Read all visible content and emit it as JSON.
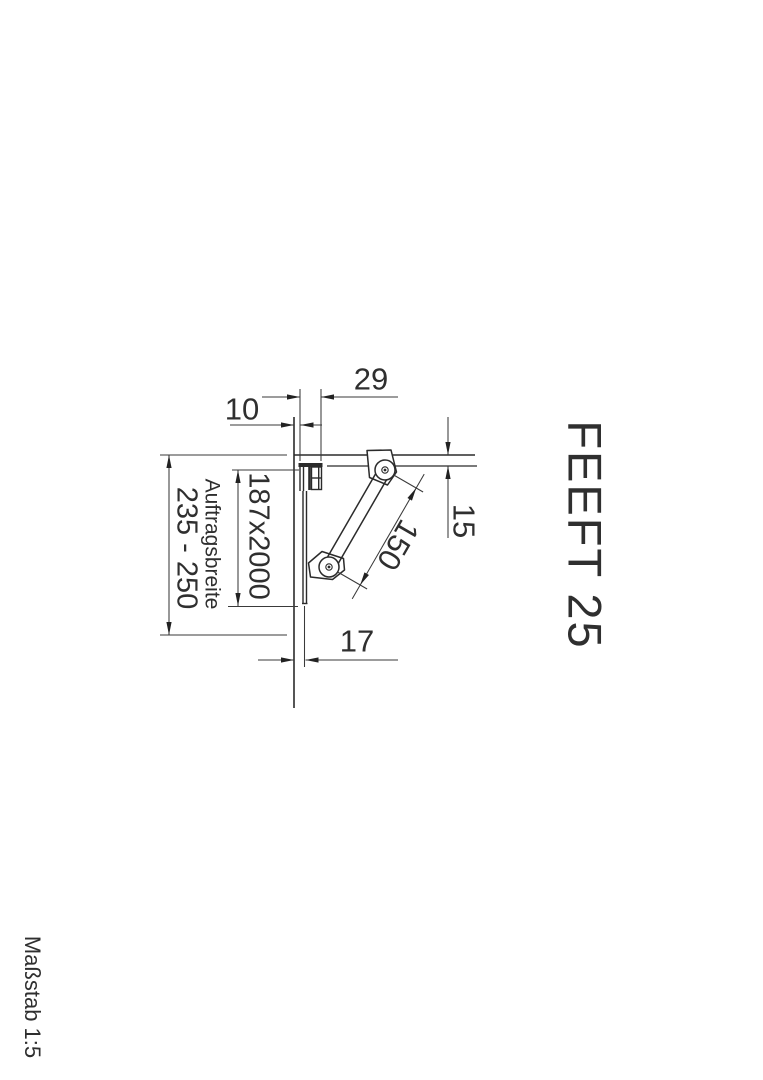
{
  "colors": {
    "background": "#ffffff",
    "line": "#2b2b2b",
    "text": "#2f2f2f"
  },
  "title": {
    "product": "FEEFT 25",
    "scale": "Maßstab 1:5"
  },
  "dims": {
    "clip_width": "29",
    "wall_gap": "10",
    "drop": "15",
    "strut_length": "150",
    "foot_offset": "17",
    "panel_size": "187x2000",
    "application_width_label": "Auftragsbreite",
    "application_width_range": "235 - 250"
  }
}
